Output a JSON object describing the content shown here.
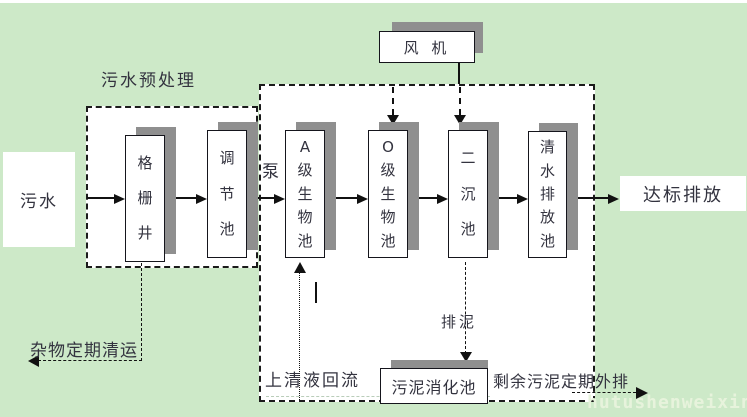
{
  "colors": {
    "background": "#cde9c8",
    "box_shadow": "#8f8f8f",
    "line": "#111111",
    "text": "#33333f",
    "watermark_text": "#e7f3dc"
  },
  "regions": {
    "pretreatment_title": "污水预处理"
  },
  "nodes": {
    "influent": "污水",
    "fan": "风 机",
    "effluent": "达标排放",
    "sludge_digestion": "污泥消化池"
  },
  "tanks": [
    {
      "name": "格栅井"
    },
    {
      "name": "调节池"
    },
    {
      "name": "A级生物池"
    },
    {
      "name": "O级生物池"
    },
    {
      "name": "二沉池"
    },
    {
      "name": "清水排放池"
    }
  ],
  "annotations": {
    "pump": "泵",
    "debris_removal": "杂物定期清运",
    "supernatant_return": "上清液回流",
    "sludge_discharge": "排泥",
    "excess_sludge": "剩余污泥定期外排"
  },
  "watermark": "hutushenweixin.com"
}
